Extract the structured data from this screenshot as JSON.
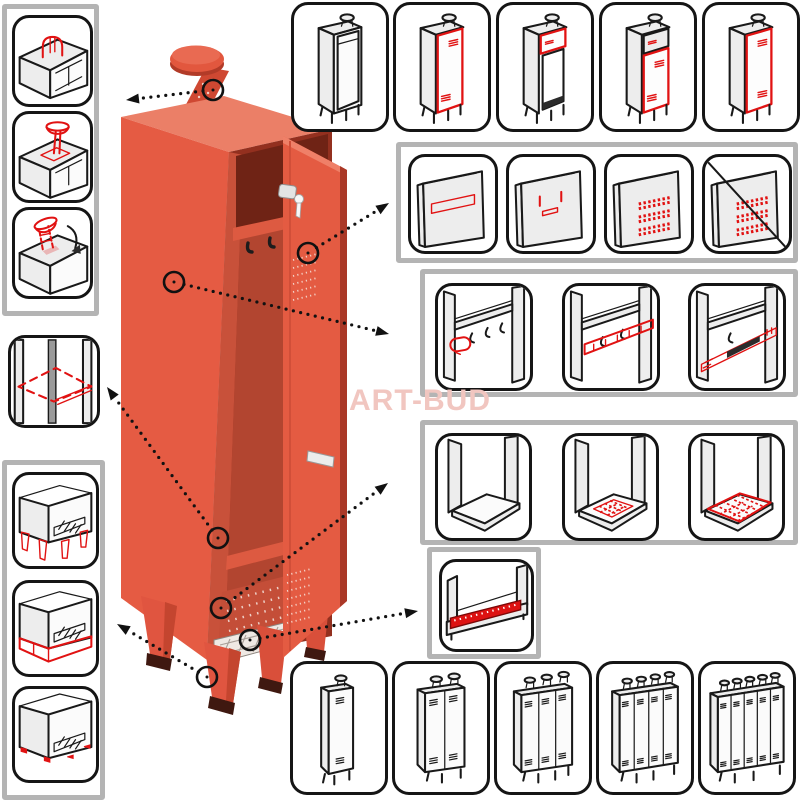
{
  "watermark": "ART-BUD",
  "colors": {
    "locker_body": "#e55b43",
    "locker_top": "#eb7f67",
    "locker_interior_dark": "#6f2315",
    "locker_interior_back": "#b24530",
    "leg_cap": "#3f1810",
    "highlight_red": "#e11212",
    "sketch_fill": "#ededed",
    "outline_black": "#191919",
    "frame_gray": "#b4b4b4",
    "watermark_pink": "#f1c6c0",
    "mat_white": "#efe9e4"
  },
  "locker": {
    "name": "metal-locker-single-column-open-door",
    "parts": [
      "roof-chimney",
      "top-shelf",
      "coat-hooks",
      "open-door",
      "door-lock-key",
      "door-handle",
      "ventilation-perforation",
      "bottom-shelf",
      "wire-mat",
      "tapered-legs"
    ]
  },
  "option_groups": {
    "roof_vents": {
      "name": "roof-ventilation-options",
      "items": [
        {
          "name": "roof-vent-cap"
        },
        {
          "name": "roof-chimney-straight"
        },
        {
          "name": "roof-chimney-tilted"
        }
      ]
    },
    "extra_shelf": {
      "name": "extra-shelf-option",
      "items": [
        {
          "name": "extra-shelf"
        }
      ]
    },
    "bases": {
      "name": "base-options",
      "items": [
        {
          "name": "tapered-feet"
        },
        {
          "name": "plinth-base"
        },
        {
          "name": "floor-glides"
        }
      ]
    },
    "door_variants": {
      "name": "door-variants",
      "items": [
        {
          "name": "no-door"
        },
        {
          "name": "full-door"
        },
        {
          "name": "top-hatch-door"
        },
        {
          "name": "hatch-plus-door"
        },
        {
          "name": "full-door-alt"
        }
      ]
    },
    "door_features": {
      "name": "door-front-features",
      "items": [
        {
          "name": "name-plate"
        },
        {
          "name": "label-slots"
        },
        {
          "name": "ventilation-perforation"
        },
        {
          "name": "no-perforation"
        }
      ]
    },
    "hanging_options": {
      "name": "interior-hanging-options",
      "items": [
        {
          "name": "extra-hook"
        },
        {
          "name": "hanging-rail-with-hooks"
        },
        {
          "name": "telescopic-rail"
        }
      ]
    },
    "floor_options": {
      "name": "interior-bottom-options",
      "items": [
        {
          "name": "plain-bottom"
        },
        {
          "name": "small-wire-mat"
        },
        {
          "name": "large-wire-mat"
        }
      ]
    },
    "bottom_rail": {
      "name": "bottom-front-rail-option",
      "items": [
        {
          "name": "bottom-front-rail"
        }
      ]
    },
    "column_variants": {
      "name": "locker-width-variants",
      "items": [
        {
          "name": "1-column"
        },
        {
          "name": "2-column"
        },
        {
          "name": "3-column"
        },
        {
          "name": "4-column"
        },
        {
          "name": "5-column"
        }
      ]
    }
  }
}
